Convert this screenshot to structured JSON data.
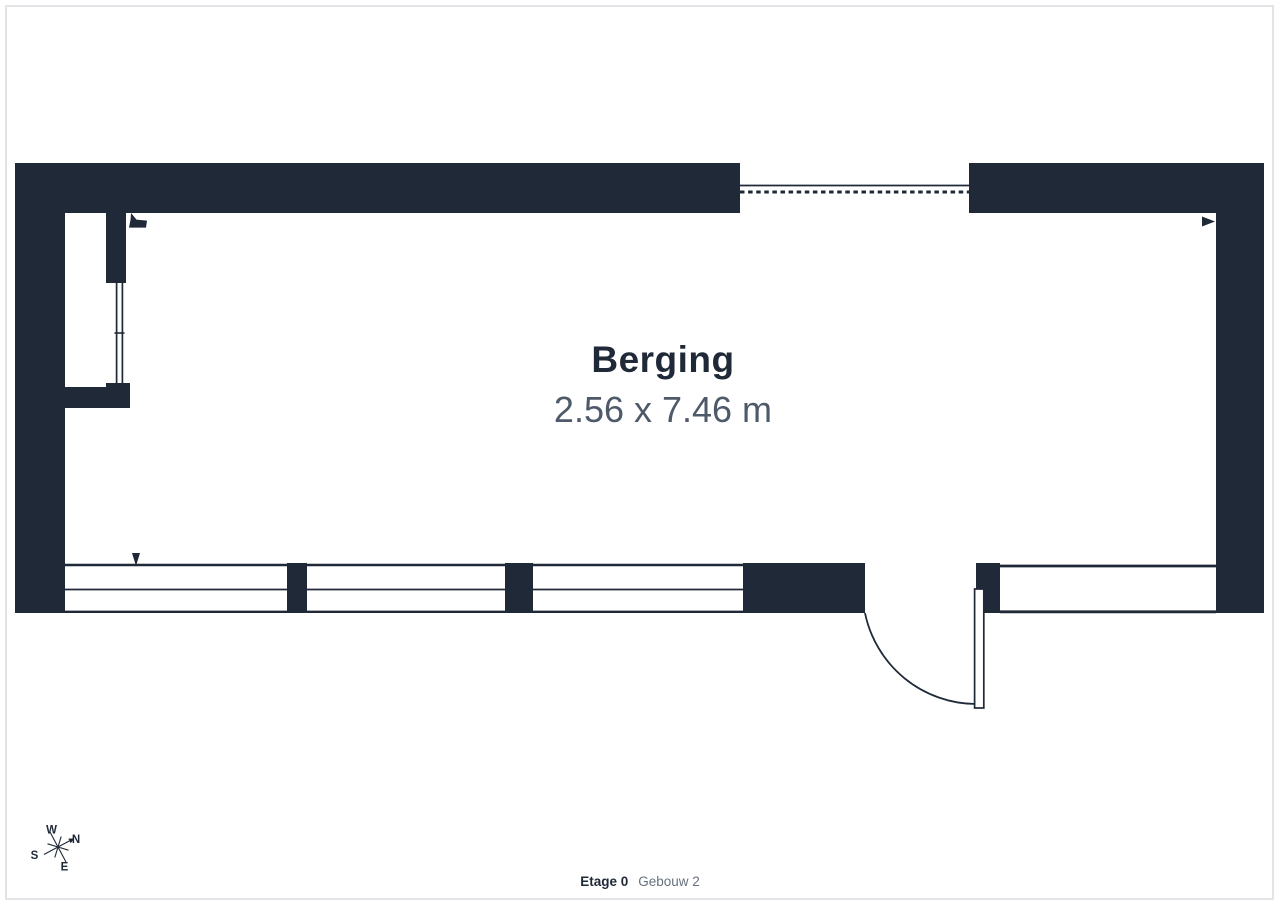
{
  "floorplan": {
    "room": {
      "name": "Berging",
      "dimensions": "2.56 x 7.46 m"
    },
    "footer": {
      "floor_label": "Etage 0",
      "building_label": "Gebouw 2"
    },
    "compass": {
      "north": "N",
      "east": "E",
      "south": "S",
      "west": "W"
    },
    "colors": {
      "wall": "#1f2937",
      "room-name": "#1f2937",
      "dimension-text": "#4e5a69",
      "footer-floor": "#1f2937",
      "footer-building": "#67717e",
      "frame-border": "#e4e4e8",
      "background": "#ffffff"
    }
  }
}
